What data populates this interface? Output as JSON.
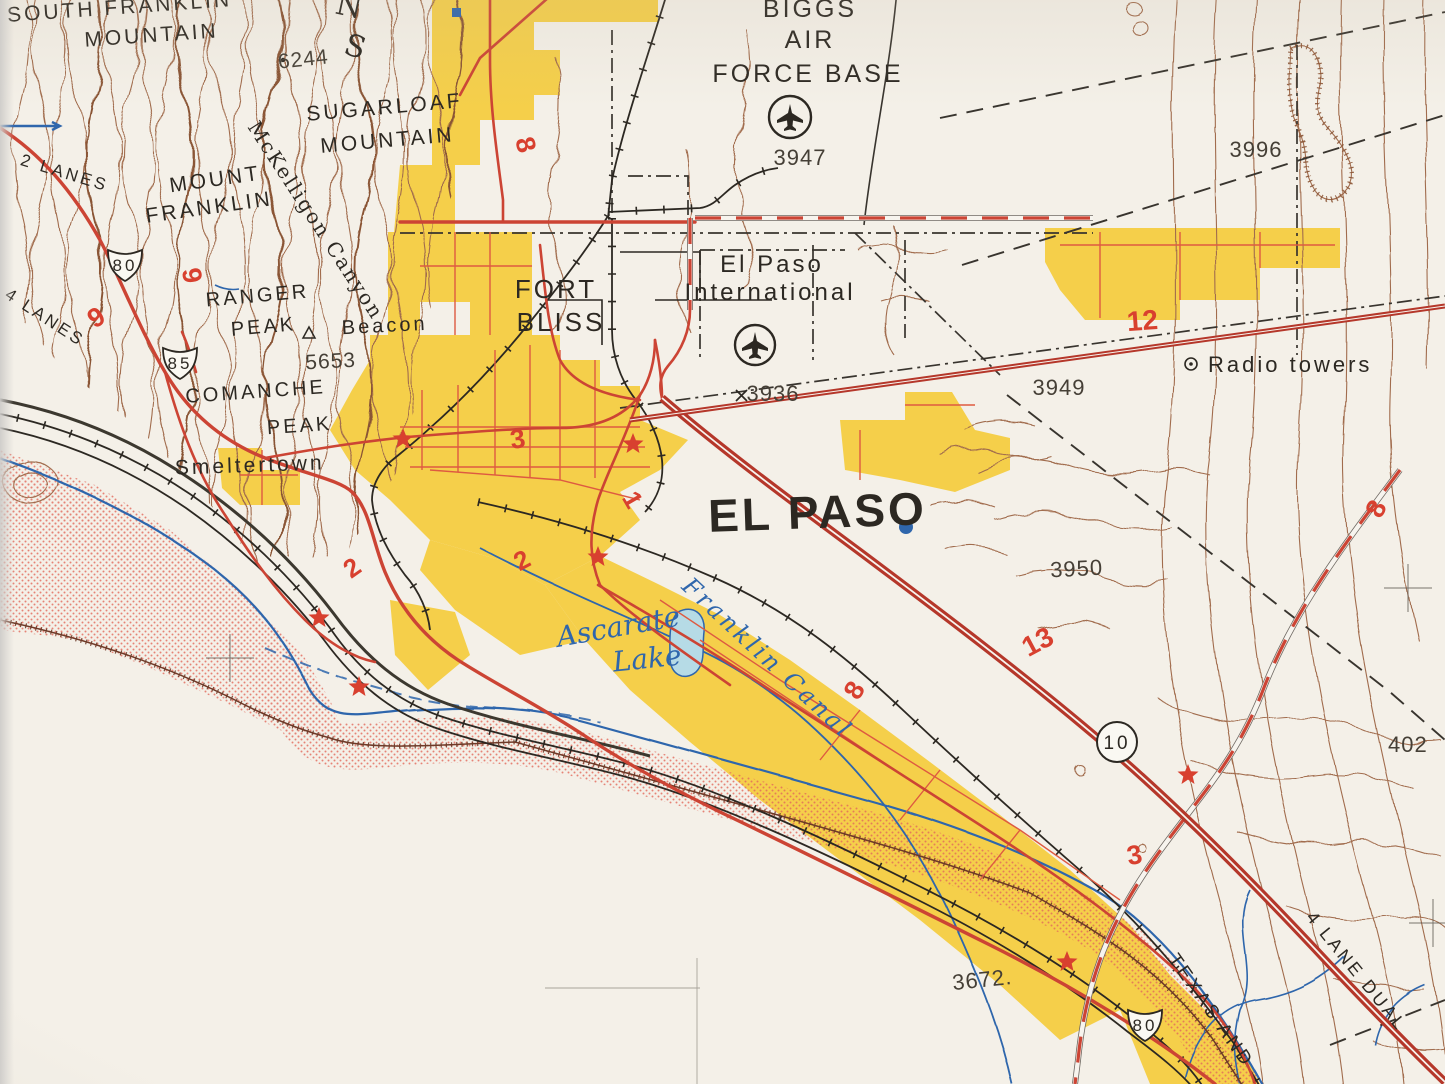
{
  "map": {
    "description": "Vintage USGS-style topographic map photo of El Paso, Texas and vicinity",
    "region": "El Paso, Texas"
  },
  "palette": {
    "paper": "#f4f0e8",
    "ink": "#2c2822",
    "gray": "#453f36",
    "contour": "#a16c4d",
    "contourdark": "#8a5435",
    "urban": "#f5cf4a",
    "road": "#cc4434",
    "roaddark": "#b5372a",
    "street": "#de5a41",
    "water": "#2f66ac",
    "lake": "#b6dbe6",
    "stipple": "#e2685a",
    "boundary": "#38342e",
    "star": "#d8402f",
    "rednum": "#d8402f"
  },
  "labels": {
    "south_franklin_1": "SOUTH FRANKLIN",
    "south_franklin_2": "MOUNTAIN",
    "range_n": "N",
    "range_s": "S",
    "elev_6244": "6244",
    "sugarloaf_1": "SUGARLOAF",
    "sugarloaf_2": "MOUNTAIN",
    "mckelligon": "McKelligon Canyon",
    "mount_franklin_1": "MOUNT",
    "mount_franklin_2": "FRANKLIN",
    "lanes_2": "2 LANES",
    "lanes_4": "4 LANES",
    "ranger_1": "RANGER",
    "ranger_2": "PEAK",
    "beacon": "Beacon",
    "elev_5653": "5653",
    "comanche_1": "COMANCHE",
    "comanche_2": "PEAK",
    "smeltertown": "Smeltertown",
    "biggs_1": "BIGGS",
    "biggs_2": "AIR",
    "biggs_3": "FORCE BASE",
    "elev_3947": "3947",
    "ep_intl_1": "El Paso",
    "ep_intl_2": "International",
    "elev_3936": "3936",
    "fort_1": "FORT",
    "fort_2": "BLISS",
    "el_paso": "EL PASO",
    "radio_towers": "Radio towers",
    "elev_3996": "3996",
    "elev_3949": "3949",
    "elev_3950": "3950",
    "elev_3672": "3672.",
    "elev_402": "402",
    "ascarate_1": "Ascarate",
    "ascarate_2": "Lake",
    "franklin_canal": "Franklin Canal",
    "texas_and": "TEXAS AND",
    "lane_dual": "4 LANE DUAL",
    "n8a": "8",
    "n9a": "9",
    "n9b": "9",
    "n12": "12",
    "n13": "13",
    "n8b": "8",
    "n8c": "8",
    "n1": "1",
    "n2a": "2",
    "n2b": "2",
    "n3a": "3",
    "n3b": "3"
  },
  "shields": {
    "us80_nw": "80",
    "us85": "85",
    "i10": "10",
    "us80_se": "80"
  }
}
